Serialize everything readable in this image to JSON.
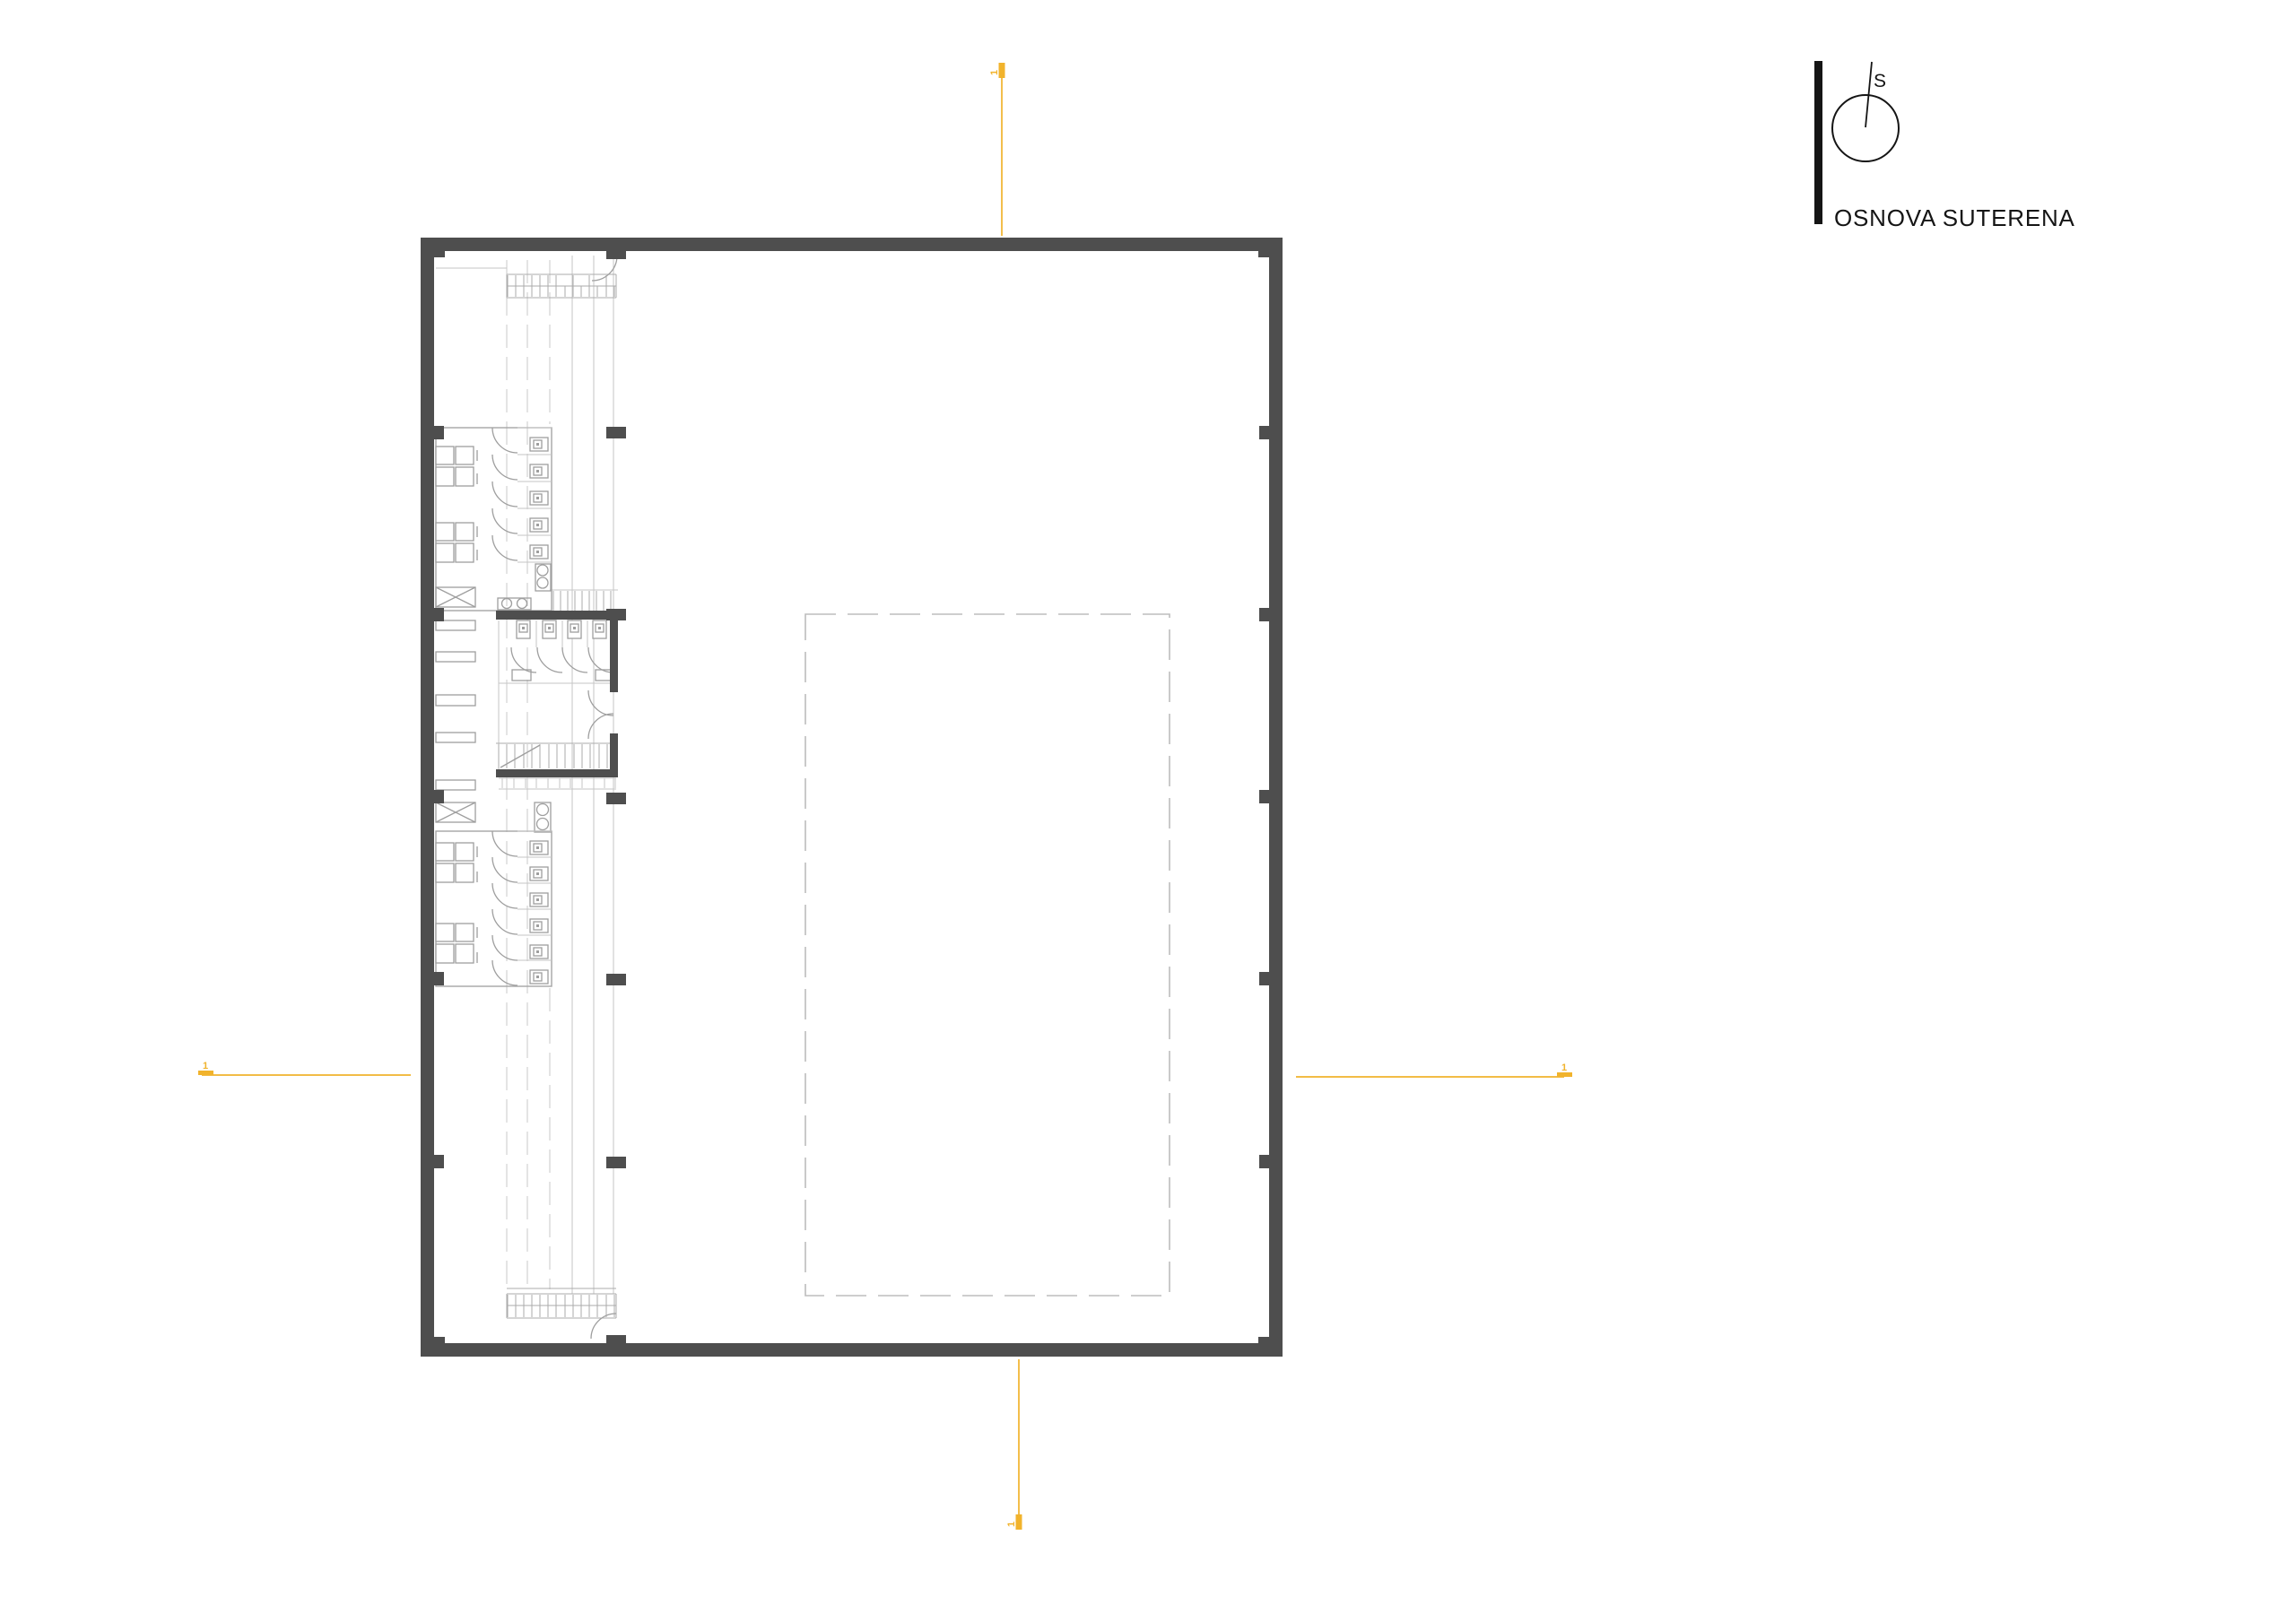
{
  "title_block": {
    "title": "OSNOVA SUTERENA",
    "north_label": "S"
  },
  "section_markers": {
    "top_label": "1",
    "bottom_label": "1",
    "left_label": "1",
    "right_label": "1"
  },
  "colors": {
    "wall": "#4E4E4E",
    "section_line": "#F1B32C",
    "fixture_line": "#9E9E9E",
    "faint_line": "#C6C6C6",
    "ink": "#151515",
    "background": "#FFFFFF"
  }
}
